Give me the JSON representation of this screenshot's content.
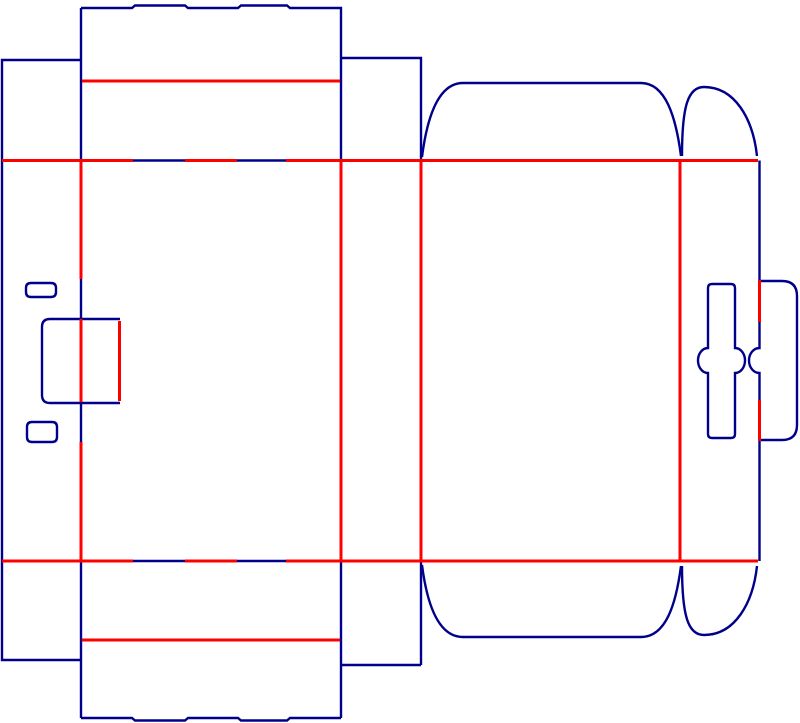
{
  "drawing": {
    "kind": "packaging-dieline",
    "canvas": {
      "width": 800,
      "height": 723,
      "background": "#ffffff"
    },
    "line_types": {
      "cut": {
        "color": "#00008B",
        "width": 2.4
      },
      "crease": {
        "color": "#FF0000",
        "width": 3
      }
    },
    "paths": [
      {
        "name": "left-glue-strip-outline",
        "type": "cut",
        "d": "M 81 60 L 2 60 L 2 660 L 81 660"
      },
      {
        "name": "left-fold-cut-segments",
        "type": "cut",
        "d": "M 81 8 L 81 160.5 M 81 279 L 81 319 M 81 402 L 81 442 M 81 561 L 81 718"
      },
      {
        "name": "top-flap-wavy-edge",
        "type": "cut",
        "d": "M 81 8 L 132 8 L 135 5.5 L 185 5.5 L 188 8 L 238 8 L 241 5.5 L 287 5.5 L 290 8 L 341 8 L 341 160.5"
      },
      {
        "name": "top-side-flap-rect",
        "type": "cut",
        "d": "M 341 58 L 421 58 L 421 160.5"
      },
      {
        "name": "top-curved-dust-flap",
        "type": "cut",
        "d": "M 422 157 C 427 118 438 83 463 83 L 641 83 C 666 83 676 118 681 156"
      },
      {
        "name": "top-petal-flap",
        "type": "cut",
        "d": "M 682 156 C 682 106 688 87 704 87 C 735 87 753 119 757 156"
      },
      {
        "name": "right-fold-cut-segments-with-thumb-notch",
        "type": "cut",
        "d": "M 759.5 160.5 L 759.5 280 M 759.5 322 L 759.5 348 A 10.5 12.5 0 0 0 759.5 373 L 759.5 400 M 759.5 441 L 759.5 561"
      },
      {
        "name": "left-slot-top",
        "type": "cut",
        "d": "M 31 283 L 51 283 Q 56 283 56 288 L 56 292 Q 56 297 51 297 L 31 297 Q 26 297 26 292 L 26 288 Q 26 283 31 283 Z"
      },
      {
        "name": "left-slot-bottom",
        "type": "cut",
        "d": "M 32 422 L 52 422 Q 57 422 57 427 L 57 437 Q 57 442 52 442 L 32 442 Q 27 442 27 437 L 27 427 Q 27 422 32 422 Z"
      },
      {
        "name": "tuck-lock-cut",
        "type": "cut",
        "d": "M 120 319 L 50 319 Q 42 319 42 327 L 42 395 Q 42 403 50 403 L 120 403"
      },
      {
        "name": "handle-slot",
        "type": "cut",
        "d": "M 712 284 L 731 284 Q 735 284 735 288 L 735 348 A 10 12.5 0 0 1 735 373 L 735 434 Q 735 438 731 438 L 712 438 Q 708 438 708 434 L 708 373 A 10 12.5 0 0 1 708 348 L 708 288 Q 708 284 712 284 Z"
      },
      {
        "name": "right-handle-tab",
        "type": "cut",
        "d": "M 760 281 L 782 281 Q 797 281 797 296 L 797 425 Q 797 440 782 440 L 760 440"
      },
      {
        "name": "bottom-side-flap-rect",
        "type": "cut",
        "d": "M 341 561 L 341 718 M 421 561 L 421 665 M 341 665 L 421 665"
      },
      {
        "name": "bottom-flap-wavy-edge",
        "type": "cut",
        "d": "M 81 718 L 132 718 L 135 720.5 L 185 720.5 L 188 718 L 238 718 L 241 720.5 L 287 720.5 L 290 718 L 341 718"
      },
      {
        "name": "bottom-curved-dust-flap",
        "type": "cut",
        "d": "M 422 565 C 427 604 438 637 463 637 L 641 637 C 666 637 676 604 681 566"
      },
      {
        "name": "bottom-petal-flap",
        "type": "cut",
        "d": "M 682 566 C 682 616 688 635 704 635 C 735 635 753 603 757 566"
      },
      {
        "name": "top-fold-cut-dashes",
        "type": "cut",
        "d": "M 133 160.5 L 185 160.5 M 237 160.5 L 286 160.5"
      },
      {
        "name": "bottom-fold-cut-dashes",
        "type": "cut",
        "d": "M 133 561 L 185 561 M 237 561 L 286 561"
      },
      {
        "name": "top-fold-crease",
        "type": "crease",
        "d": "M 2 160.5 L 133 160.5 M 185 160.5 L 237 160.5 M 286 160.5 L 758 160.5"
      },
      {
        "name": "bottom-fold-crease",
        "type": "crease",
        "d": "M 2 561 L 133 561 M 185 561 L 237 561 M 286 561 L 758 561"
      },
      {
        "name": "top-flap-crease",
        "type": "crease",
        "d": "M 82 81 L 340 81"
      },
      {
        "name": "bottom-flap-crease",
        "type": "crease",
        "d": "M 82 640 L 340 640"
      },
      {
        "name": "left-fold-crease-segments",
        "type": "crease",
        "d": "M 81 160.5 L 81 279 M 81 319 L 81 402 M 81 442 L 81 561"
      },
      {
        "name": "panel-crease-1",
        "type": "crease",
        "d": "M 341 160.5 L 341 561"
      },
      {
        "name": "panel-crease-2",
        "type": "crease",
        "d": "M 421 160.5 L 421 561"
      },
      {
        "name": "panel-crease-3",
        "type": "crease",
        "d": "M 680 160.5 L 680 561"
      },
      {
        "name": "right-fold-crease-segments",
        "type": "crease",
        "d": "M 759.5 280 L 759.5 322 M 759.5 400 L 759.5 441"
      },
      {
        "name": "tuck-lock-crease",
        "type": "crease",
        "d": "M 119.5 321 L 119.5 401"
      }
    ]
  }
}
